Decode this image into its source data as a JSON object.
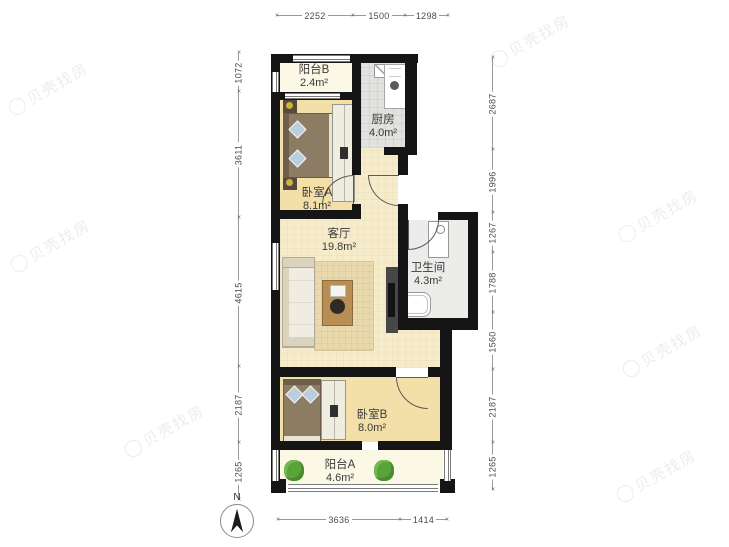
{
  "floorplan": {
    "type": "apartment-floorplan",
    "rooms": [
      {
        "id": "balcony-b",
        "name": "阳台B",
        "area": "2.4m²"
      },
      {
        "id": "kitchen",
        "name": "厨房",
        "area": "4.0m²"
      },
      {
        "id": "bedroom-a",
        "name": "卧室A",
        "area": "8.1m²"
      },
      {
        "id": "living-room",
        "name": "客厅",
        "area": "19.8m²"
      },
      {
        "id": "bathroom",
        "name": "卫生间",
        "area": "4.3m²"
      },
      {
        "id": "bedroom-b",
        "name": "卧室B",
        "area": "8.0m²"
      },
      {
        "id": "balcony-a",
        "name": "阳台A",
        "area": "4.6m²"
      }
    ],
    "dimensions_mm": {
      "top": [
        "2252",
        "1500",
        "1298"
      ],
      "left": [
        "1072",
        "3611",
        "4615",
        "2187",
        "1265"
      ],
      "right": [
        "2687",
        "1996",
        "1267",
        "1788",
        "1560",
        "2187",
        "1265"
      ],
      "bottom": [
        "3636",
        "1414"
      ]
    },
    "compass": {
      "label": "N"
    },
    "watermark": {
      "text": "贝壳找房"
    },
    "colors": {
      "wall": "#151515",
      "floor_bedroom": "#f3dfa8",
      "floor_living": "#f6ecca",
      "floor_balcony": "#fbf8e6",
      "floor_kitchen": "#e2e2e0",
      "floor_bathroom": "#ececea",
      "plant_green": "#5aa33b",
      "bed_brown": "#8d7c64",
      "table_brown": "#b98e55",
      "dimension_text": "#4a4a4a",
      "label_text": "#3a3a3a"
    }
  }
}
